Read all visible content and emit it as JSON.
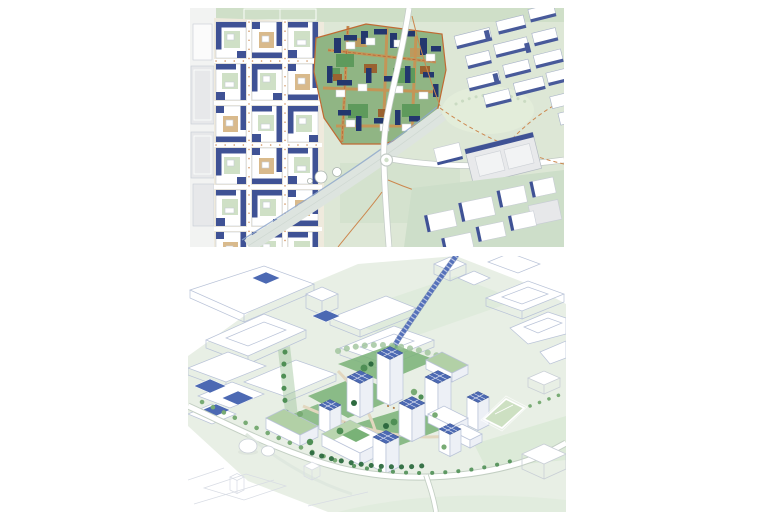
{
  "page": {
    "background": "#ffffff"
  },
  "figures": {
    "top": {
      "icon": "masterplan-site-plan-map"
    },
    "bottom": {
      "icon": "axonometric-aerial-view"
    }
  },
  "colors": {
    "sp_park": "#dde7d6",
    "sp_park2": "#cfdfc8",
    "sp_parkblob": "#e3edda",
    "sp_cream": "#efeadd",
    "sp_white": "#ffffff",
    "sp_grey": "#e7e8ea",
    "sp_greybig": "#e8e9eb",
    "sp_navy": "#3f5295",
    "sp_court": "#cfe0c6",
    "sp_tan": "#d9ba8c",
    "sp_sitebase": "#90b584",
    "sp_sitenavy": "#23376e",
    "sp_sitegreen": "#5e9a5c",
    "sp_sitebrown": "#9a6230",
    "sp_sitetan": "#c79455",
    "sp_band": "#dde4df",
    "sp_canal": "#8fa8cc",
    "sp_segrnd": "#cddec9",
    "sp_outline": "#c7ccd4",
    "sp_orange": "#cc874e",
    "sp_red": "#b5502a",
    "sp_roadcase": "#c3cbc6",
    "sp_slabline": "#a8b2c8",
    "sp_siteedge": "#c06a33",
    "ax_ground": "#e8efe5",
    "ax_ground2": "#dcead8",
    "ax_lawn": "#79b277",
    "ax_lawn2": "#cde0c2",
    "ax_groof": "#b2d0a6",
    "ax_face": "#ffffff",
    "ax_face2": "#edf0f6",
    "ax_solar": "#4c69b3",
    "ax_solaredge": "#3a5390",
    "ax_tan": "#dcc9a6",
    "ax_wire": "#b9c3d8",
    "ax_wire2": "#d8dce4",
    "ax_route": "#5571ba",
    "ax_roadcase": "#c3cfc3",
    "ax_tree": "#4f8f55",
    "ax_tree2": "#78ab74",
    "ax_tree3": "#2e6b40",
    "ax_brown": "#b07a45",
    "ax_path": "#e2d7bf",
    "ax_grey": "#c9cfd6",
    "ax_ltgreen": "#9dc39a",
    "ax_pond": "#2b4a8e"
  }
}
